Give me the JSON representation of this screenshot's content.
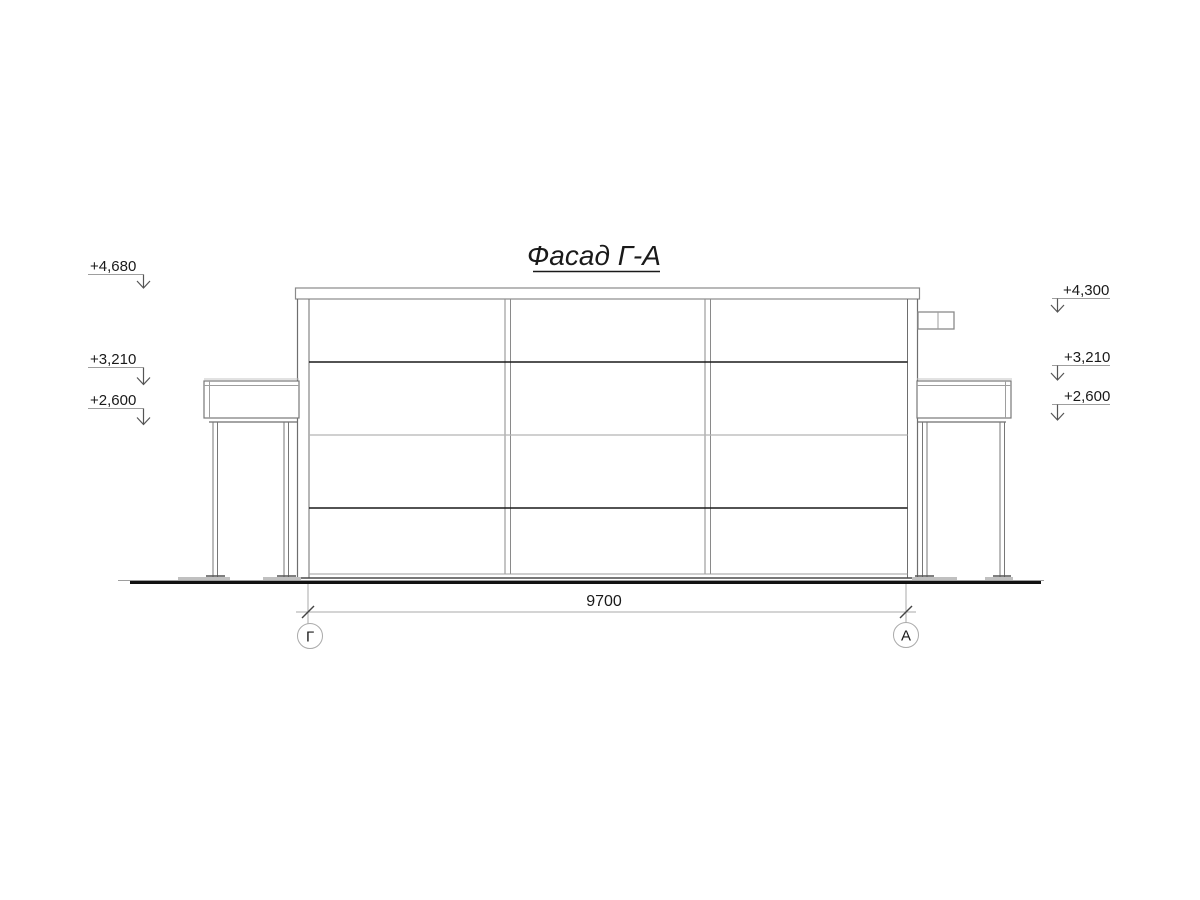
{
  "drawing": {
    "title": "Фасад Г-А",
    "dimension": {
      "label": "9700"
    },
    "axes": {
      "left": {
        "label": "Г"
      },
      "right": {
        "label": "А"
      }
    },
    "elevations_left": [
      {
        "label": "+4,680"
      },
      {
        "label": "+3,210"
      },
      {
        "label": "+2,600"
      }
    ],
    "elevations_right": [
      {
        "label": "+4,300"
      },
      {
        "label": "+3,210"
      },
      {
        "label": "+2,600"
      }
    ],
    "colors": {
      "background": "#ffffff",
      "line_dark": "#1a1a1a",
      "line_medium": "#6e6e6e",
      "line_light": "#aaaaaa",
      "text": "#1a1a1a"
    }
  }
}
